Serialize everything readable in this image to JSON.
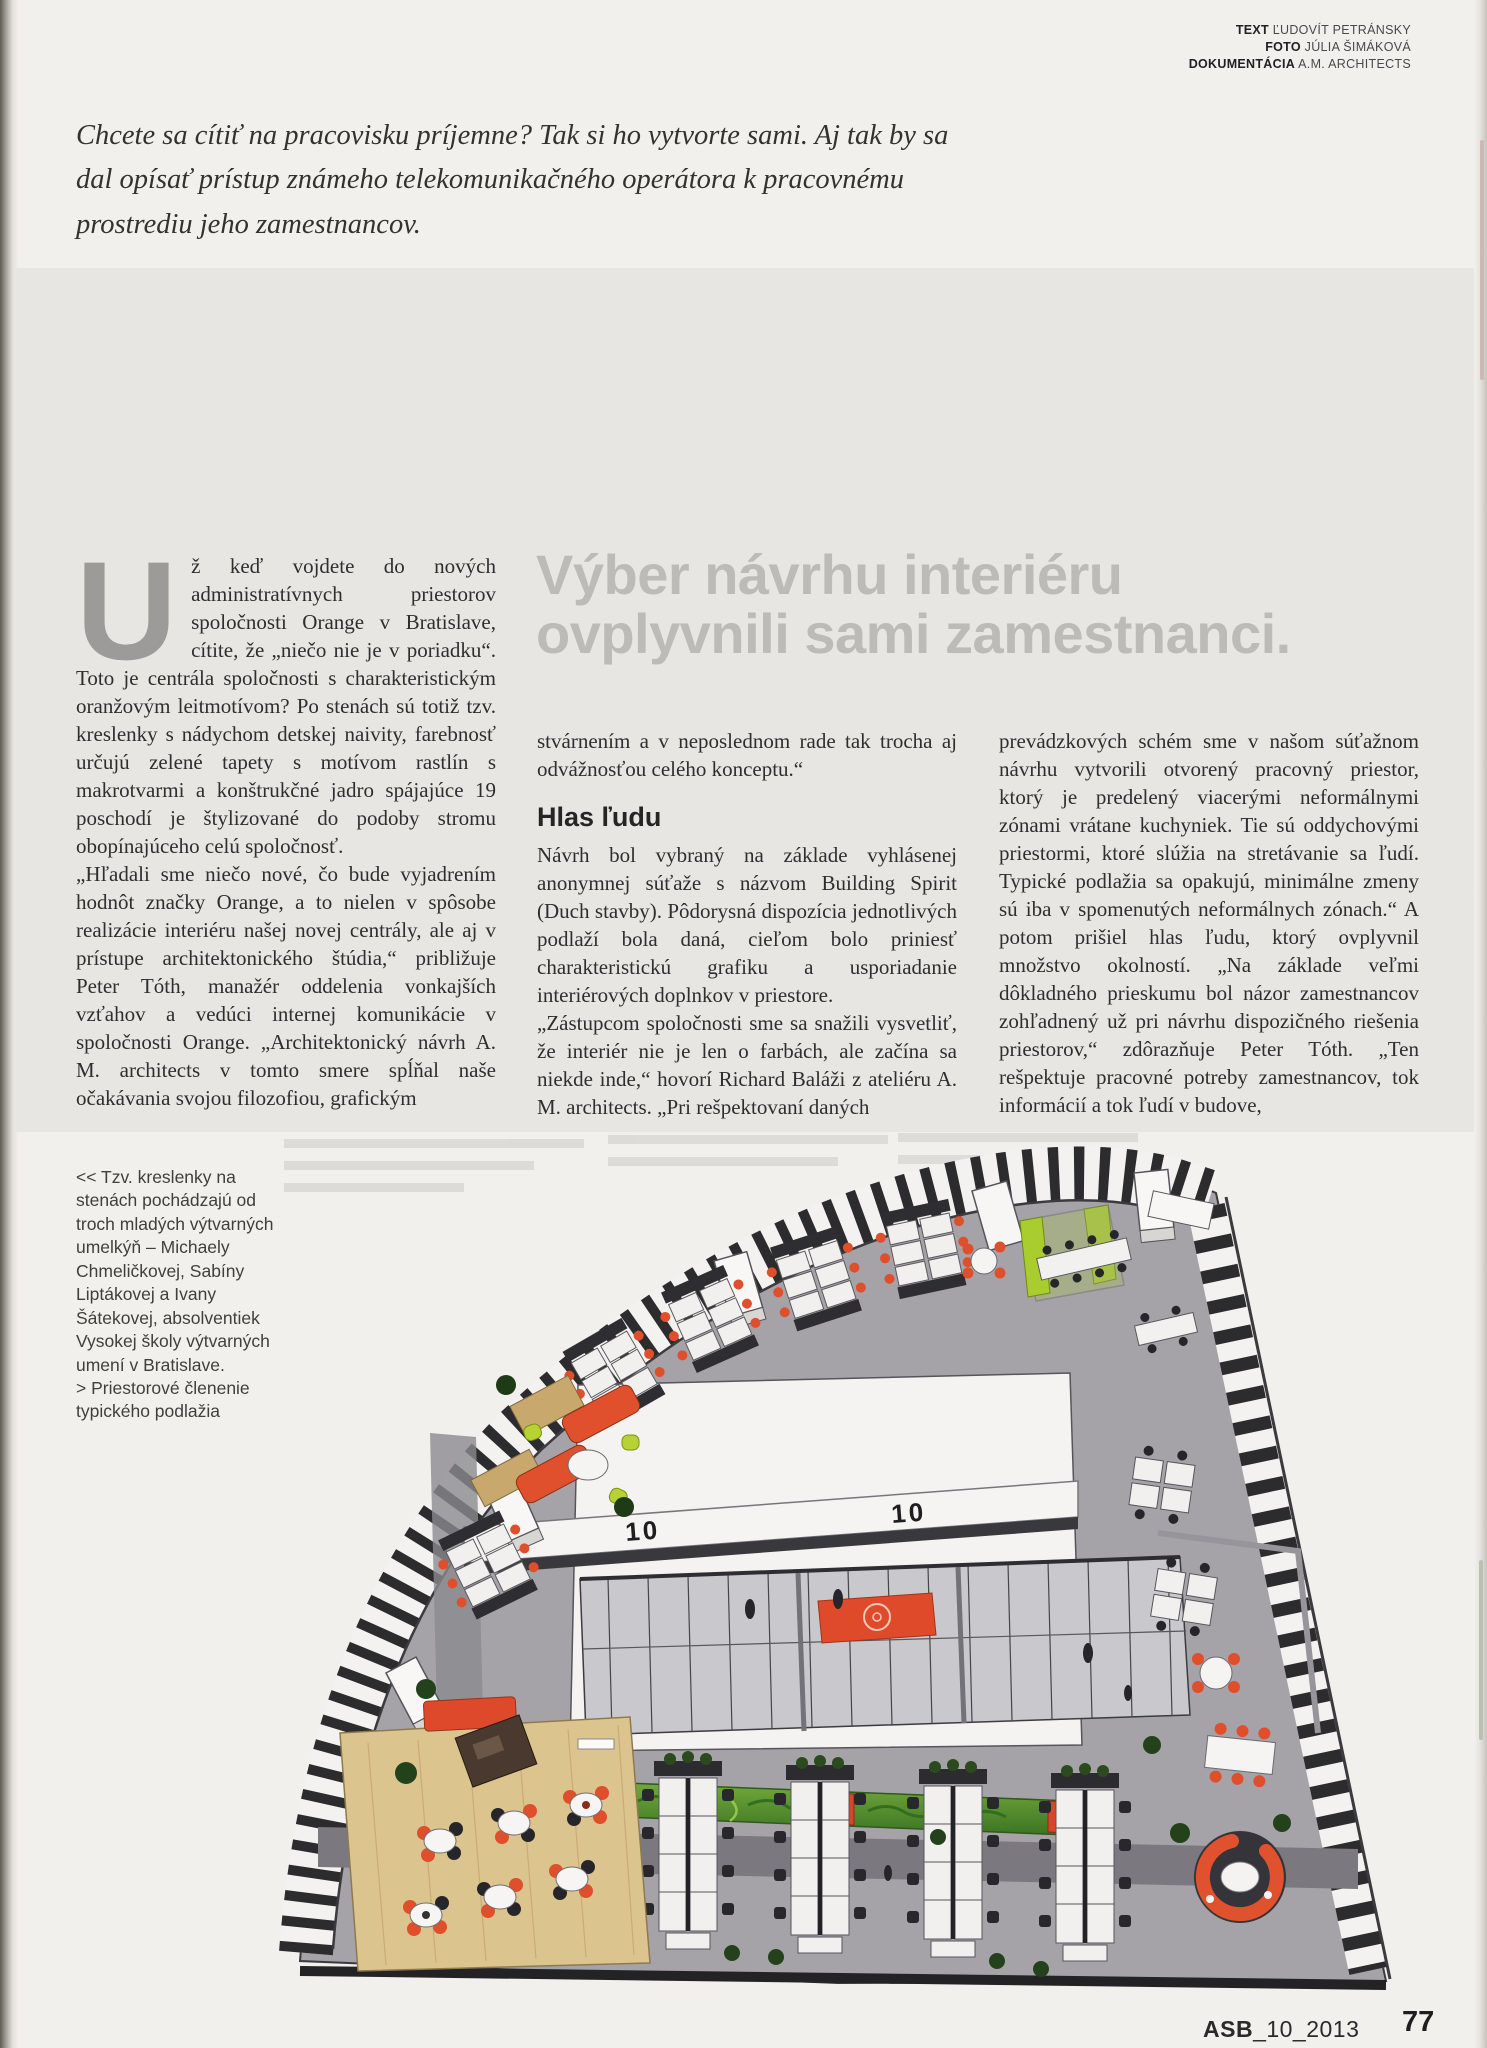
{
  "credits": {
    "rows": [
      {
        "label": "TEXT",
        "value": "ĽUDOVÍT PETRÁNSKY"
      },
      {
        "label": "FOTO",
        "value": "JÚLIA ŠIMÁKOVÁ"
      },
      {
        "label": "DOKUMENTÁCIA",
        "value": "A.M. ARCHITECTS"
      }
    ]
  },
  "intro": "Chcete sa cítiť na pracovisku príjemne? Tak si ho vytvorte sami. Aj tak by sa dal opísať prístup známeho telekomunikačného operátora k pracovnému prostrediu jeho zamestnancov.",
  "headline": "Výber návrhu interiéru ovplyvnili sami zamestnanci.",
  "article": {
    "dropcap": "U",
    "col1_p1": "ž keď vojdete do nových administratívnych priestorov spoločnosti Orange v Bratislave, cítite, že „niečo nie je v poriadku“. Toto je centrála spoločnosti s charakteristickým oranžovým leitmotívom? Po stenách sú totiž tzv. kreslenky s nádychom detskej naivity, farebnosť určujú zelené tapety s motívom rastlín s makrotvarmi a konštrukčné jadro spájajúce 19 poschodí je štylizované do podoby stromu obopínajúceho celú spoločnosť.",
    "col1_p2": "„Hľadali sme niečo nové, čo bude vyjadrením hodnôt značky Orange, a to nielen v spôsobe realizácie interiéru našej novej centrály, ale aj v prístupe architektonického štúdia,“ približuje Peter Tóth, manažér oddelenia vonkajších vzťahov a vedúci internej komunikácie v spoločnosti Orange. „Architektonický návrh A. M. architects v tomto smere spĺňal naše očakávania svojou filozofiou, grafickým",
    "col2_p1": "stvárnením a v neposlednom rade tak trocha aj odvážnosťou celého konceptu.“",
    "col2_subhead": "Hlas ľudu",
    "col2_p2": "Návrh bol vybraný na základe vyhlásenej anonymnej súťaže s názvom Building Spirit (Duch stavby). Pôdorysná dispozícia jednotlivých podlaží bola daná, cieľom bolo priniesť charakteristickú grafiku a usporiadanie interiérových doplnkov v priestore.",
    "col2_p3": "„Zástupcom spoločnosti sme sa snažili vysvetliť, že interiér nie je len o farbách, ale začína sa niekde inde,“ hovorí Richard Baláži z ateliéru A. M. architects. „Pri rešpektovaní daných",
    "col3_p1": "prevádzkových schém sme v našom súťažnom návrhu vytvorili otvorený pracovný priestor, ktorý je predelený viacerými neformálnymi zónami vrátane kuchyniek. Tie sú oddychovými priestormi, ktoré slúžia na stretávanie sa ľudí. Typické podlažia sa opakujú, minimálne zmeny sú iba v spomenutých neformálnych zónach.“ A potom prišiel hlas ľudu, ktorý ovplyvnil množstvo okolností. „Na základe veľmi dôkladného prieskumu bol názor zamestnancov zohľadnený už pri návrhu dispozičného riešenia priestorov,“ zdôrazňuje Peter Tóth. „Ten rešpektuje pracovné potreby zamestnancov, tok informácií a tok ľudí v budove,"
  },
  "caption": {
    "items": [
      {
        "prefix": "<<",
        "text": "Tzv. kreslenky na stenách pochádzajú od troch mladých výtvarných umelkýň – Michaely Chmeličkovej, Sabíny Liptákovej a Ivany Šátekovej, absolventiek Vysokej školy výtvarných umení v Bratislave."
      },
      {
        "prefix": ">",
        "text": "Priestorové členenie typického podlažia"
      }
    ]
  },
  "floorplan": {
    "beam_label_1": "10",
    "beam_label_2": "10",
    "colors": {
      "accent_orange": "#df4f2c",
      "lime_green": "#b3d134",
      "wall_green": "#4e8c33",
      "floor_gray": "#a5a3a8",
      "wood": "#dcc48f",
      "stripe_dark": "#2c2b2d"
    }
  },
  "footer": {
    "journal_bold": "ASB",
    "journal_rest": "_10_2013",
    "page_number": "77"
  }
}
